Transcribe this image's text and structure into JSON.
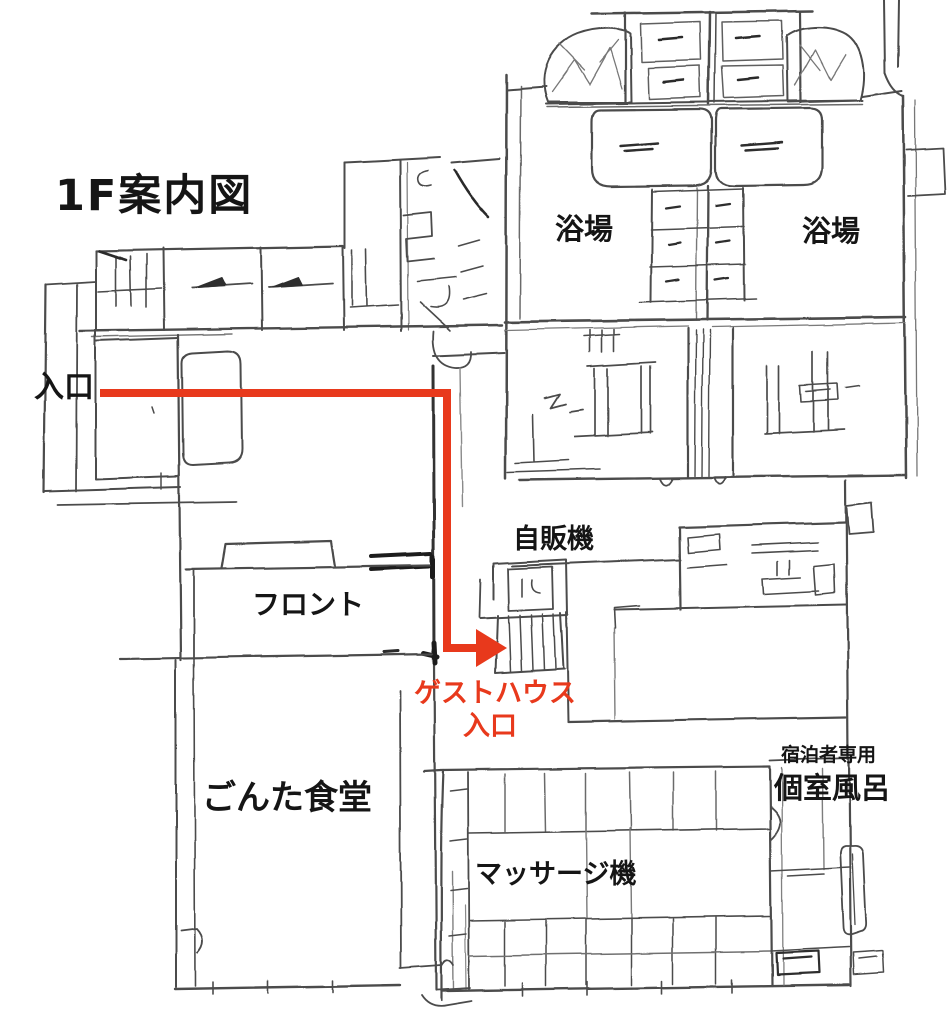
{
  "page": {
    "background": "#ffffff"
  },
  "title": {
    "text": "1F案内図"
  },
  "floorplan": {
    "rooms": {
      "bath_left": "浴場",
      "bath_right": "浴場",
      "front_desk": "フロント",
      "dining_hall": "ごんた食堂",
      "private_bath": "個室風呂",
      "private_bath_note": "宿泊者専用"
    },
    "features": {
      "entrance": "入口",
      "vending_machine": "自販機",
      "massage_machine": "マッサージ機"
    },
    "route": {
      "color": "#e8391c",
      "label_line1": "ゲストハウス",
      "label_line2": "入口"
    },
    "colors": {
      "ink": "#4b4b4b",
      "ink_dark": "#1f1f1f",
      "text": "#151515",
      "background": "#ffffff"
    }
  }
}
